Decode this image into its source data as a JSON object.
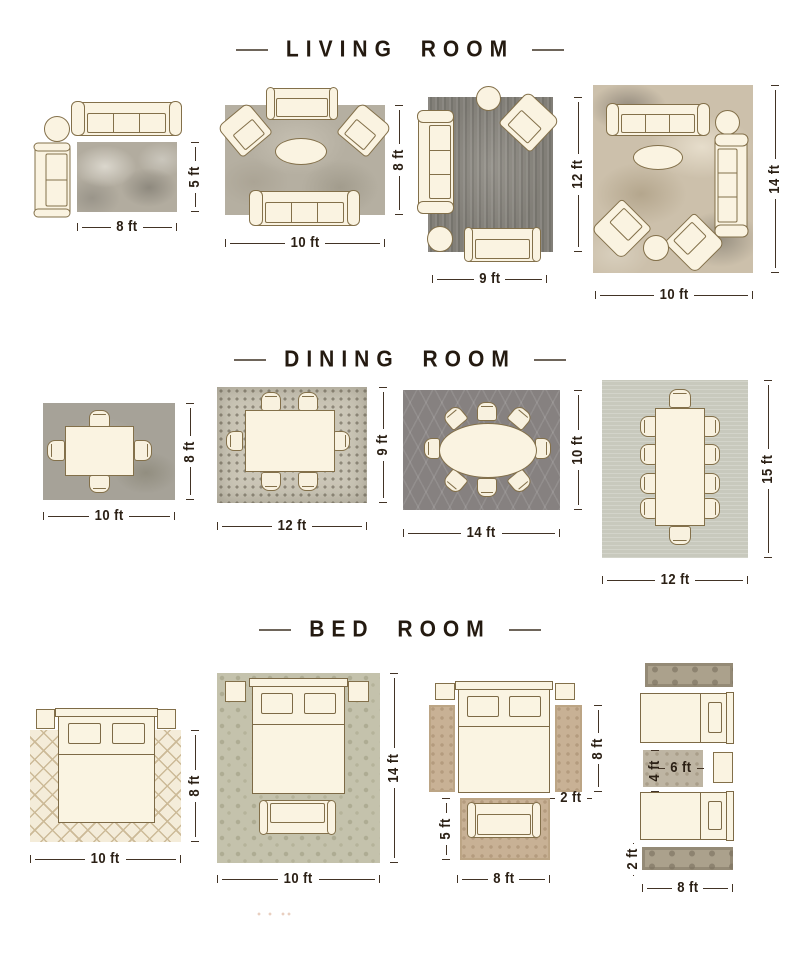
{
  "colors": {
    "background": "#ffffff",
    "ink": "#2b2015",
    "header_text": "#241a10",
    "header_dash": "#6e655a",
    "furniture_fill": "#faf3e1",
    "furniture_outline": "#83704a",
    "rug_gray_mottled": "#b2ac9f",
    "rug_dark_gray": "#827f78",
    "rug_beige_abstract": "#ccc0ab",
    "rug_mosaic": "#cbc6b7",
    "rug_trellis_dark": "#868180",
    "rug_sage": "#c8c9bd",
    "rug_cream_lattice": "#f4ecd9",
    "rug_damask_sage": "#c4c2ac",
    "rug_tan": "#c8b195",
    "rug_runner_ornate": "#aba18c"
  },
  "sections": [
    {
      "title": "LIVING ROOM",
      "layouts": [
        {
          "width": "8 ft",
          "height": "5 ft"
        },
        {
          "width": "10 ft",
          "height": "8 ft"
        },
        {
          "width": "9 ft",
          "height": "12 ft"
        },
        {
          "width": "10 ft",
          "height": "14 ft"
        }
      ]
    },
    {
      "title": "DINING ROOM",
      "layouts": [
        {
          "width": "10 ft",
          "height": "8 ft"
        },
        {
          "width": "12 ft",
          "height": "9 ft"
        },
        {
          "width": "14 ft",
          "height": "10 ft"
        },
        {
          "width": "12 ft",
          "height": "15 ft"
        }
      ]
    },
    {
      "title": "BED ROOM",
      "layouts": [
        {
          "width": "10 ft",
          "height": "8 ft"
        },
        {
          "width": "10 ft",
          "height": "14 ft"
        },
        {
          "runner_height": "8 ft",
          "runner_width": "2 ft",
          "seating_rug_height": "5 ft",
          "seating_rug_width": "8 ft"
        },
        {
          "accent_rug_height": "4 ft",
          "accent_rug_width": "6 ft",
          "runner_height": "2 ft",
          "runner_width": "8 ft"
        }
      ]
    }
  ]
}
